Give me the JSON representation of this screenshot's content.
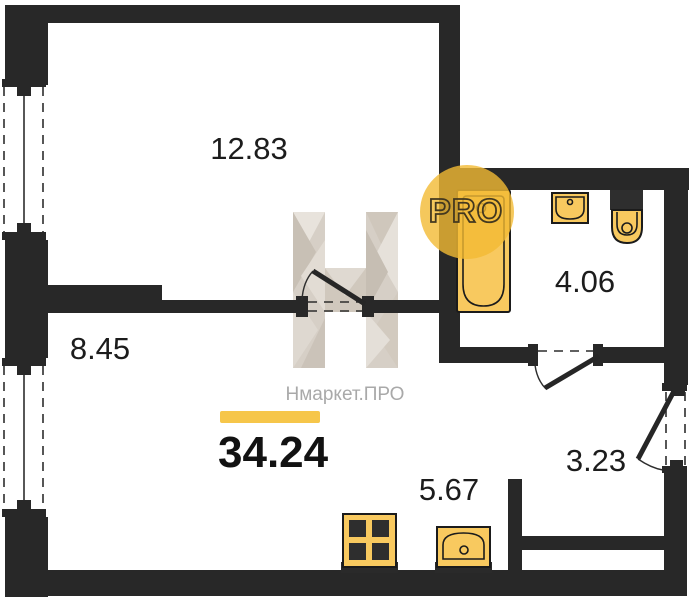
{
  "plan": {
    "total_area": "34.24",
    "rooms": [
      {
        "id": "living-room",
        "area": "12.83"
      },
      {
        "id": "bedroom",
        "area": "8.45"
      },
      {
        "id": "bathroom",
        "area": "4.06"
      },
      {
        "id": "kitchen",
        "area": "5.67"
      },
      {
        "id": "hallway",
        "area": "3.23"
      }
    ],
    "fixtures": [
      "bathtub",
      "bath-sink",
      "toilet",
      "stove",
      "kitchen-sink"
    ],
    "colors": {
      "wall": "#282828",
      "fixture_fill": "#f8c95f",
      "accent_bar": "#f6c64a",
      "badge_circle": "#f2ba33",
      "brand_text": "#a9a9a9",
      "logo_facet": "#d9d2c9"
    }
  },
  "watermark": {
    "brand": "Нмаркет.ПРО",
    "badge": "PRO"
  }
}
